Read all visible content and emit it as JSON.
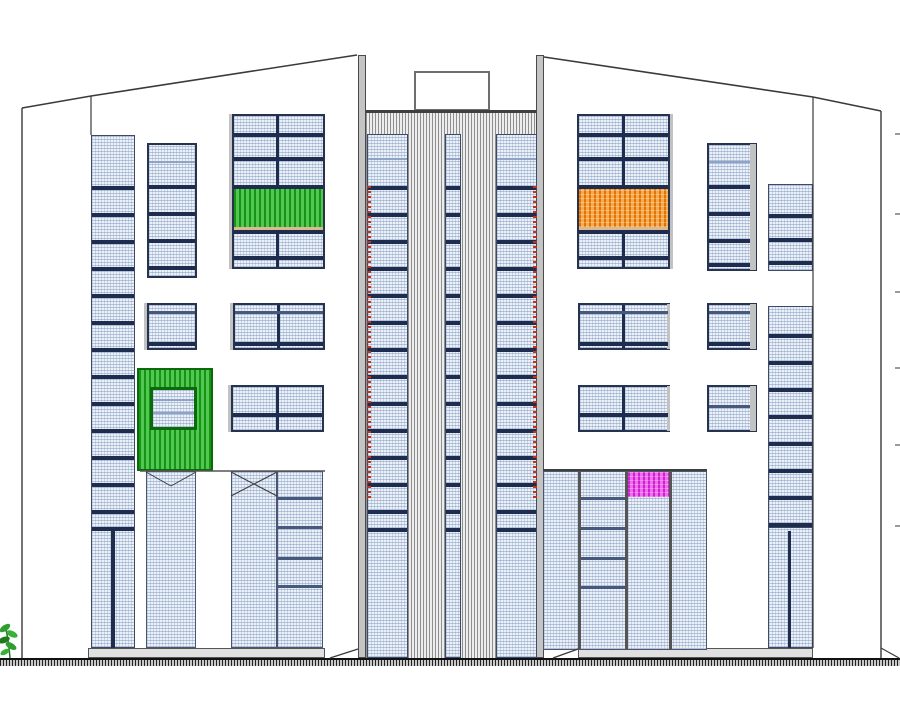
{
  "drawing": {
    "kind": "building-front-elevation",
    "canvas": {
      "width": 900,
      "height": 701
    }
  },
  "colors": {
    "outline": "#3a3a3a",
    "navy": "#1e2c4d",
    "window_border": "#26324e",
    "gray_fill": "#c4c4c4",
    "green_dark": "#169416",
    "green_light": "#52c852",
    "green_frame": "#0b6b0b",
    "orange_dark": "#e27300",
    "orange_light": "#f7a94f",
    "magenta_dark": "#cf1fcf",
    "magenta_light": "#f06df0",
    "red_tick": "#c23317",
    "tan": "#dcb890",
    "ground": "#111111",
    "plant_green": "#2e9e2e",
    "plant_green_dark": "#1d7a1d"
  },
  "elements": [
    {
      "n": "plinth-left",
      "c": "plinth",
      "x": 88,
      "y": 648,
      "w": 237,
      "h": 10
    },
    {
      "n": "plinth-right",
      "c": "plinth",
      "x": 578,
      "y": 648,
      "w": 235,
      "h": 10
    },
    {
      "n": "roof-box",
      "c": "box",
      "x": 414,
      "y": 71,
      "w": 76,
      "h": 40
    },
    {
      "n": "tower-body",
      "c": "hatchv",
      "x": 366,
      "y": 110,
      "w": 170,
      "h": 548
    },
    {
      "n": "tower-top-line",
      "c": "topline",
      "x": 366,
      "y": 110,
      "w": 170,
      "h": 3
    },
    {
      "n": "pilaster-left",
      "c": "pilaster",
      "x": 358,
      "y": 55,
      "w": 8,
      "h": 603
    },
    {
      "n": "pilaster-right",
      "c": "pilaster",
      "x": 536,
      "y": 55,
      "w": 8,
      "h": 603
    },
    {
      "n": "tower-strip-left",
      "c": "strip",
      "x": 367,
      "y": 134,
      "w": 41,
      "h": 524
    },
    {
      "n": "tower-strip-center",
      "c": "strip",
      "x": 445,
      "y": 134,
      "w": 16,
      "h": 524
    },
    {
      "n": "tower-strip-right",
      "c": "strip",
      "x": 496,
      "y": 134,
      "w": 41,
      "h": 524
    },
    {
      "n": "tower-strip-left-raillight",
      "c": "rail-light",
      "x": 368,
      "w": 39,
      "h": 2,
      "ys": [
        158
      ]
    },
    {
      "n": "tower-strip-center-raillight",
      "c": "rail-light",
      "x": 446,
      "w": 14,
      "h": 2,
      "ys": [
        158
      ]
    },
    {
      "n": "tower-strip-right-raillight",
      "c": "rail-light",
      "x": 497,
      "w": 39,
      "h": 2,
      "ys": [
        158
      ]
    },
    {
      "n": "tower-strip-left-rails",
      "c": "rail-dark",
      "x": 368,
      "w": 39,
      "h": 4,
      "ys": [
        186,
        213,
        240,
        267,
        294,
        321,
        348,
        375,
        402,
        429,
        456,
        483,
        510,
        528
      ]
    },
    {
      "n": "tower-strip-center-rails",
      "c": "rail-dark",
      "x": 446,
      "w": 14,
      "h": 4,
      "ys": [
        186,
        213,
        240,
        267,
        294,
        321,
        348,
        375,
        402,
        429,
        456,
        483,
        510,
        528
      ]
    },
    {
      "n": "tower-strip-right-rails",
      "c": "rail-dark",
      "x": 497,
      "w": 39,
      "h": 4,
      "ys": [
        186,
        213,
        240,
        267,
        294,
        321,
        348,
        375,
        402,
        429,
        456,
        483,
        510,
        528
      ]
    },
    {
      "n": "tower-red-ticks-left",
      "c": "red-tick",
      "x": 367,
      "y": 186,
      "w": 4,
      "h": 312
    },
    {
      "n": "tower-red-ticks-right",
      "c": "red-tick",
      "x": 533,
      "y": 186,
      "w": 4,
      "h": 312
    },
    {
      "n": "left-facade-strip",
      "c": "strip",
      "x": 91,
      "y": 135,
      "w": 44,
      "h": 513
    },
    {
      "n": "left-facade-strip-rails",
      "c": "rail-dark",
      "x": 92,
      "w": 42,
      "h": 4,
      "ys": [
        186,
        213,
        240,
        267,
        294,
        321,
        348,
        375,
        402,
        429,
        456,
        483,
        510,
        527
      ]
    },
    {
      "n": "left-facade-strip-mullion",
      "c": "vbar",
      "x": 111,
      "y": 531,
      "w": 4,
      "h": 117
    },
    {
      "n": "left-column-window",
      "c": "window",
      "x": 147,
      "y": 143,
      "w": 50,
      "h": 135
    },
    {
      "n": "left-column-window-raillight",
      "c": "rail-light",
      "x": 149,
      "w": 46,
      "h": 2,
      "ys": [
        161
      ]
    },
    {
      "n": "left-column-window-rails",
      "c": "rail-dark",
      "x": 149,
      "w": 46,
      "h": 4,
      "ys": [
        185,
        212,
        239,
        266
      ]
    },
    {
      "n": "big-window-left-shadow",
      "c": "shadow",
      "x": 229,
      "y": 114,
      "w": 3,
      "h": 155
    },
    {
      "n": "big-window-left",
      "c": "window",
      "x": 232,
      "y": 114,
      "w": 93,
      "h": 155
    },
    {
      "n": "big-window-left-mullion",
      "c": "vbar",
      "x": 276,
      "y": 116,
      "w": 3,
      "h": 151
    },
    {
      "n": "big-window-left-rails",
      "c": "rail-dark",
      "x": 234,
      "w": 89,
      "h": 4,
      "ys": [
        133,
        157,
        185,
        230,
        256
      ]
    },
    {
      "n": "green-louver-band",
      "c": "green-stripe",
      "x": 234,
      "y": 189,
      "w": 89,
      "h": 38
    },
    {
      "n": "green-band-sill",
      "c": "tan-row",
      "x": 234,
      "y": 227,
      "w": 89,
      "h": 3
    },
    {
      "n": "mid-window-left-small-shadow",
      "c": "shadow",
      "x": 144,
      "y": 303,
      "w": 3,
      "h": 47
    },
    {
      "n": "mid-window-left-small",
      "c": "window",
      "x": 147,
      "y": 303,
      "w": 50,
      "h": 47
    },
    {
      "n": "mid-window-left-small-rail1",
      "c": "rail-mid",
      "x": 149,
      "w": 46,
      "h": 3,
      "ys": [
        311
      ]
    },
    {
      "n": "mid-window-left-small-rail2",
      "c": "rail-dark",
      "x": 149,
      "w": 46,
      "h": 4,
      "ys": [
        342
      ]
    },
    {
      "n": "mid-window-left-wide-shadow",
      "c": "shadow",
      "x": 230,
      "y": 303,
      "w": 3,
      "h": 47
    },
    {
      "n": "mid-window-left-wide",
      "c": "window",
      "x": 233,
      "y": 303,
      "w": 92,
      "h": 47
    },
    {
      "n": "mid-window-left-wide-mullion",
      "c": "vbar",
      "x": 277,
      "y": 305,
      "w": 3,
      "h": 43
    },
    {
      "n": "mid-window-left-wide-rail1",
      "c": "rail-mid",
      "x": 235,
      "w": 88,
      "h": 3,
      "ys": [
        311
      ]
    },
    {
      "n": "mid-window-left-wide-rail2",
      "c": "rail-dark",
      "x": 235,
      "w": 88,
      "h": 4,
      "ys": [
        342
      ]
    },
    {
      "n": "green-balcony-square",
      "c": "green-square",
      "x": 137,
      "y": 368,
      "w": 76,
      "h": 103
    },
    {
      "n": "green-balcony-window",
      "c": "window-green",
      "x": 150,
      "y": 387,
      "w": 47,
      "h": 43
    },
    {
      "n": "green-balcony-window-rails",
      "c": "rail-light",
      "x": 153,
      "w": 41,
      "h": 2,
      "ys": [
        399,
        412
      ]
    },
    {
      "n": "low-window-left-wide-shadow",
      "c": "shadow",
      "x": 228,
      "y": 385,
      "w": 3,
      "h": 47
    },
    {
      "n": "low-window-left-wide",
      "c": "window",
      "x": 231,
      "y": 385,
      "w": 93,
      "h": 47
    },
    {
      "n": "low-window-left-wide-mullion",
      "c": "vbar",
      "x": 276,
      "y": 387,
      "w": 3,
      "h": 43
    },
    {
      "n": "low-window-left-wide-rail",
      "c": "rail-dark",
      "x": 233,
      "w": 89,
      "h": 4,
      "ys": [
        413
      ]
    },
    {
      "n": "entrance-door-left",
      "c": "door",
      "x": 146,
      "y": 471,
      "w": 50,
      "h": 177
    },
    {
      "n": "entrance-door-right",
      "c": "door",
      "x": 231,
      "y": 471,
      "w": 46,
      "h": 177
    },
    {
      "n": "entrance-side-panel",
      "c": "door",
      "x": 277,
      "y": 471,
      "w": 46,
      "h": 177
    },
    {
      "n": "entrance-side-panel-rails",
      "c": "rail-mid",
      "x": 278,
      "w": 44,
      "h": 3,
      "ys": [
        497,
        526,
        557,
        585
      ]
    },
    {
      "n": "lobby-glazing-topline",
      "c": "topline",
      "x": 543,
      "y": 469,
      "w": 164,
      "h": 2
    },
    {
      "n": "lobby-glazing",
      "c": "door",
      "x": 543,
      "y": 471,
      "w": 164,
      "h": 179
    },
    {
      "n": "lobby-mullion-1",
      "c": "vbar-gray",
      "x": 578,
      "y": 471,
      "w": 3,
      "h": 179
    },
    {
      "n": "lobby-mullion-2",
      "c": "vbar-gray",
      "x": 625,
      "y": 471,
      "w": 3,
      "h": 179
    },
    {
      "n": "lobby-mullion-3",
      "c": "vbar-gray",
      "x": 669,
      "y": 471,
      "w": 3,
      "h": 179
    },
    {
      "n": "magenta-panel",
      "c": "magenta-stripe",
      "x": 628,
      "y": 472,
      "w": 41,
      "h": 25
    },
    {
      "n": "lobby-col2-rails",
      "c": "rail-mid",
      "x": 581,
      "w": 44,
      "h": 3,
      "ys": [
        497,
        527,
        557,
        586
      ]
    },
    {
      "n": "big-window-right",
      "c": "window",
      "x": 577,
      "y": 114,
      "w": 93,
      "h": 155
    },
    {
      "n": "big-window-right-shadow",
      "c": "shadow",
      "x": 670,
      "y": 114,
      "w": 3,
      "h": 155
    },
    {
      "n": "big-window-right-mullion",
      "c": "vbar",
      "x": 622,
      "y": 116,
      "w": 3,
      "h": 151
    },
    {
      "n": "big-window-right-rails",
      "c": "rail-dark",
      "x": 579,
      "w": 89,
      "h": 4,
      "ys": [
        133,
        157,
        185,
        230,
        256
      ]
    },
    {
      "n": "orange-louver-band",
      "c": "orange-stripe",
      "x": 579,
      "y": 189,
      "w": 89,
      "h": 38
    },
    {
      "n": "orange-band-sill",
      "c": "tan-row",
      "x": 579,
      "y": 227,
      "w": 89,
      "h": 3
    },
    {
      "n": "right-column-window",
      "c": "window",
      "x": 707,
      "y": 143,
      "w": 50,
      "h": 128
    },
    {
      "n": "right-column-window-shadow",
      "c": "shadow",
      "x": 750,
      "y": 144,
      "w": 6,
      "h": 126
    },
    {
      "n": "right-column-window-raillight",
      "c": "rail-light",
      "x": 709,
      "w": 41,
      "h": 2,
      "ys": [
        161
      ]
    },
    {
      "n": "right-column-window-rails",
      "c": "rail-dark",
      "x": 709,
      "w": 41,
      "h": 4,
      "ys": [
        185,
        212,
        239,
        263
      ]
    },
    {
      "n": "mid-window-right-wide",
      "c": "window",
      "x": 578,
      "y": 303,
      "w": 92,
      "h": 47
    },
    {
      "n": "mid-window-right-wide-shadow",
      "c": "shadow",
      "x": 667,
      "y": 304,
      "w": 3,
      "h": 45
    },
    {
      "n": "mid-window-right-wide-mullion",
      "c": "vbar",
      "x": 622,
      "y": 305,
      "w": 3,
      "h": 43
    },
    {
      "n": "mid-window-right-wide-rail1",
      "c": "rail-mid",
      "x": 580,
      "w": 88,
      "h": 3,
      "ys": [
        311
      ]
    },
    {
      "n": "mid-window-right-wide-rail2",
      "c": "rail-dark",
      "x": 580,
      "w": 88,
      "h": 4,
      "ys": [
        342
      ]
    },
    {
      "n": "mid-window-right-small",
      "c": "window",
      "x": 707,
      "y": 303,
      "w": 50,
      "h": 47
    },
    {
      "n": "mid-window-right-small-shadow",
      "c": "shadow",
      "x": 750,
      "y": 304,
      "w": 6,
      "h": 45
    },
    {
      "n": "mid-window-right-small-rail1",
      "c": "rail-mid",
      "x": 709,
      "w": 41,
      "h": 3,
      "ys": [
        311
      ]
    },
    {
      "n": "mid-window-right-small-rail2",
      "c": "rail-dark",
      "x": 709,
      "w": 41,
      "h": 4,
      "ys": [
        342
      ]
    },
    {
      "n": "low-window-right-wide",
      "c": "window",
      "x": 578,
      "y": 385,
      "w": 92,
      "h": 47
    },
    {
      "n": "low-window-right-wide-shadow",
      "c": "shadow",
      "x": 667,
      "y": 386,
      "w": 3,
      "h": 45
    },
    {
      "n": "low-window-right-wide-mullion",
      "c": "vbar",
      "x": 622,
      "y": 387,
      "w": 3,
      "h": 43
    },
    {
      "n": "low-window-right-wide-rail",
      "c": "rail-dark",
      "x": 580,
      "w": 88,
      "h": 4,
      "ys": [
        413
      ]
    },
    {
      "n": "low-window-right-small",
      "c": "window",
      "x": 707,
      "y": 385,
      "w": 50,
      "h": 47
    },
    {
      "n": "low-window-right-small-shadow",
      "c": "shadow",
      "x": 750,
      "y": 386,
      "w": 6,
      "h": 45
    },
    {
      "n": "low-window-right-small-rail",
      "c": "rail-mid",
      "x": 709,
      "w": 41,
      "h": 3,
      "ys": [
        405
      ]
    },
    {
      "n": "right-facade-strip-upper",
      "c": "strip",
      "x": 768,
      "y": 184,
      "w": 45,
      "h": 87
    },
    {
      "n": "right-facade-strip-upper-rails",
      "c": "rail-dark",
      "x": 769,
      "w": 43,
      "h": 4,
      "ys": [
        214,
        238,
        261
      ]
    },
    {
      "n": "right-facade-strip-mid",
      "c": "strip",
      "x": 768,
      "y": 306,
      "w": 45,
      "h": 221
    },
    {
      "n": "right-facade-strip-mid-rails",
      "c": "rail-dark",
      "x": 769,
      "w": 43,
      "h": 4,
      "ys": [
        334,
        361,
        388,
        415,
        442,
        469,
        496,
        523
      ]
    },
    {
      "n": "right-facade-strip-lower",
      "c": "strip",
      "x": 768,
      "y": 527,
      "w": 45,
      "h": 121
    },
    {
      "n": "right-facade-strip-lower-mullion",
      "c": "vbar",
      "x": 788,
      "y": 531,
      "w": 3,
      "h": 117
    },
    {
      "n": "level-ticks-right",
      "c": "tick",
      "x": 895,
      "w": 5,
      "h": 2,
      "ys": [
        133,
        213,
        291,
        367,
        444,
        525
      ]
    },
    {
      "n": "ground-strip",
      "c": "ground-hatch",
      "x": 0,
      "y": 658,
      "w": 900,
      "h": 8
    }
  ],
  "lines": [
    {
      "n": "left-building-edge",
      "x1": 22,
      "y1": 108,
      "x2": 22,
      "y2": 658,
      "w": 1.4
    },
    {
      "n": "left-roof-segment-1",
      "x1": 22,
      "y1": 108,
      "x2": 91,
      "y2": 96,
      "w": 1.6
    },
    {
      "n": "left-roof-segment-2",
      "x1": 91,
      "y1": 96,
      "x2": 357,
      "y2": 55,
      "w": 1.6
    },
    {
      "n": "left-plane-corner",
      "x1": 91,
      "y1": 96,
      "x2": 91,
      "y2": 135,
      "w": 1.2
    },
    {
      "n": "right-roof-segment-1",
      "x1": 544,
      "y1": 57,
      "x2": 813,
      "y2": 97,
      "w": 1.6
    },
    {
      "n": "right-roof-segment-2",
      "x1": 813,
      "y1": 97,
      "x2": 881,
      "y2": 111,
      "w": 1.6
    },
    {
      "n": "right-plane-corner",
      "x1": 813,
      "y1": 97,
      "x2": 813,
      "y2": 648,
      "w": 1.2
    },
    {
      "n": "right-building-edge",
      "x1": 881,
      "y1": 111,
      "x2": 881,
      "y2": 658,
      "w": 1.4
    },
    {
      "n": "entrance-header-line",
      "x1": 140,
      "y1": 471,
      "x2": 325,
      "y2": 471,
      "w": 1.5,
      "c": "#555"
    },
    {
      "n": "door-left-chevron-a",
      "x1": 146,
      "y1": 472,
      "x2": 171,
      "y2": 486,
      "w": 1
    },
    {
      "n": "door-left-chevron-b",
      "x1": 196,
      "y1": 472,
      "x2": 171,
      "y2": 486,
      "w": 1
    },
    {
      "n": "door-right-cross-a",
      "x1": 231,
      "y1": 472,
      "x2": 277,
      "y2": 496,
      "w": 1
    },
    {
      "n": "door-right-cross-b",
      "x1": 277,
      "y1": 472,
      "x2": 231,
      "y2": 496,
      "w": 1
    },
    {
      "n": "ramp-left-of-tower",
      "x1": 330,
      "y1": 658,
      "x2": 358,
      "y2": 649,
      "w": 1.2
    },
    {
      "n": "ramp-right-of-tower",
      "x1": 553,
      "y1": 658,
      "x2": 578,
      "y2": 649,
      "w": 1.2
    },
    {
      "n": "right-corner-ramp",
      "x1": 881,
      "y1": 648,
      "x2": 899,
      "y2": 658,
      "w": 1.2
    }
  ],
  "plant": {
    "x": 0,
    "y": 616
  }
}
